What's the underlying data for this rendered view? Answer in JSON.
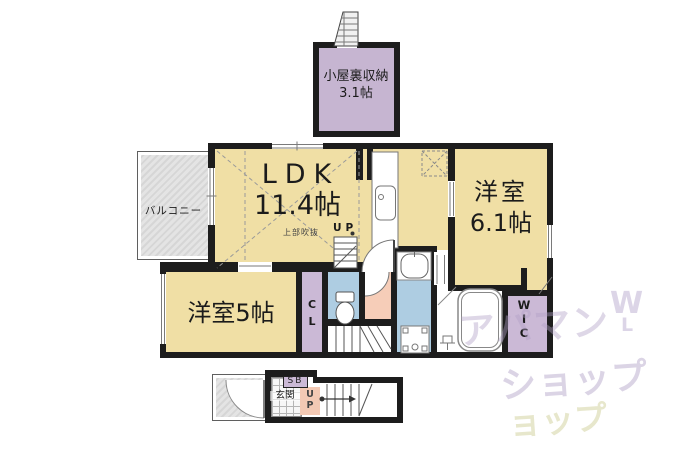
{
  "plan": {
    "attic": {
      "name": "小屋裏収納",
      "size": "3.1帖"
    },
    "balcony": {
      "name": "バルコニー"
    },
    "ldk": {
      "name": "LDK",
      "size": "11.4帖",
      "void_note": "上部吹抜",
      "up_label": "UP"
    },
    "bedroom_5": {
      "name": "洋室5帖"
    },
    "bedroom_61": {
      "name": "洋室",
      "size": "6.1帖"
    },
    "closet": {
      "l1": "C",
      "l2": "L"
    },
    "wic": {
      "l1": "W",
      "l2": "I",
      "l3": "C"
    },
    "entrance": {
      "name": "玄関",
      "shoebox": "SB",
      "up1": "U",
      "up2": "P"
    }
  },
  "watermark": {
    "line1": "アパマン",
    "line2": "ショップ",
    "line3": "ョップ",
    "mark1": "W",
    "mark2": "L"
  },
  "colors": {
    "wall": "#1D1D1D",
    "room_tan": "#F0DFA5",
    "room_purple": "#CBB9D6",
    "room_blue": "#AECDE2",
    "room_pink": "#F6CDB8",
    "balcony_gray": "#DCDCDC",
    "watermark_purple": "#B0A0C6",
    "watermark_olive": "#B9B96E"
  }
}
